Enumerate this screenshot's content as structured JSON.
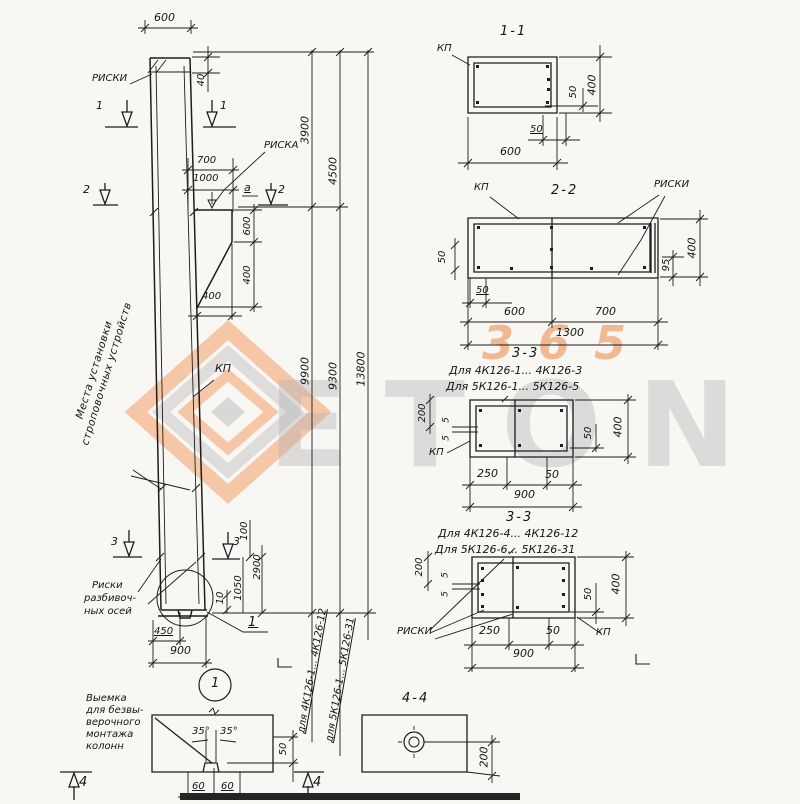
{
  "watermark": {
    "word": "ETON",
    "number": "365"
  },
  "column": {
    "riski_top": "РИСКИ",
    "riska": "РИСКА",
    "kp": "КП",
    "dim_a": "а",
    "note_line1": "Места установки",
    "note_line2": "строповочных устройств",
    "axes_l1": "Риски",
    "axes_l2": "разбивоч-",
    "axes_l3": "ных осей",
    "detail_ref": "1",
    "detail_circle": "1",
    "s1": "1",
    "s2": "2",
    "s3": "3",
    "dims": {
      "top_width": "600",
      "recess": "40",
      "d700": "700",
      "d1000": "1000",
      "console_h": "600",
      "below_console": "400",
      "console_w": "400",
      "h1": "3900",
      "h2": "4500",
      "h3": "9900",
      "h4": "9300",
      "h_total": "13800",
      "d100": "100",
      "d2900": "2900",
      "d1050": "1050",
      "d10": "10",
      "d450": "450",
      "base": "900"
    },
    "range1": "для 4К126-1... 4К126-12",
    "range2": "для 5К126-1... 5К126-31"
  },
  "sec11": {
    "title": "1-1",
    "kp": "КП",
    "d400": "400",
    "d50v": "50",
    "d50h": "50",
    "d600": "600"
  },
  "sec22": {
    "title": "2-2",
    "kp": "КП",
    "riski": "РИСКИ",
    "d50l": "50",
    "d50b": "50",
    "d600": "600",
    "d700": "700",
    "d1300": "1300",
    "d400": "400",
    "d95": "95"
  },
  "sec33a": {
    "title": "3-3",
    "for1": "Для 4К126-1... 4К126-3",
    "for2": "Для 5К126-1... 5К126-5",
    "kp": "КП",
    "d200": "200",
    "d5a": "5",
    "d5b": "5",
    "d50r": "50",
    "d400": "400",
    "d250": "250",
    "d50": "50",
    "d900": "900"
  },
  "sec33b": {
    "title": "3-3",
    "for1": "Для 4К126-4... 4К126-12",
    "for2": "Для 5К126-6... 5К126-31",
    "kp": "КП",
    "riski": "РИСКИ",
    "d200": "200",
    "d5a": "5",
    "d5b": "5",
    "d50r": "50",
    "d400": "400",
    "d250": "250",
    "d50": "50",
    "d900": "900"
  },
  "sec44": {
    "title": "4-4",
    "d200": "200"
  },
  "notch": {
    "l1": "Выемка",
    "l2": "для безвы-",
    "l3": "верочного",
    "l4": "монтажа",
    "l5": "колонн",
    "a35a": "35°",
    "a35b": "35°",
    "d60a": "60",
    "d60b": "60",
    "d50": "50",
    "s4": "4"
  }
}
